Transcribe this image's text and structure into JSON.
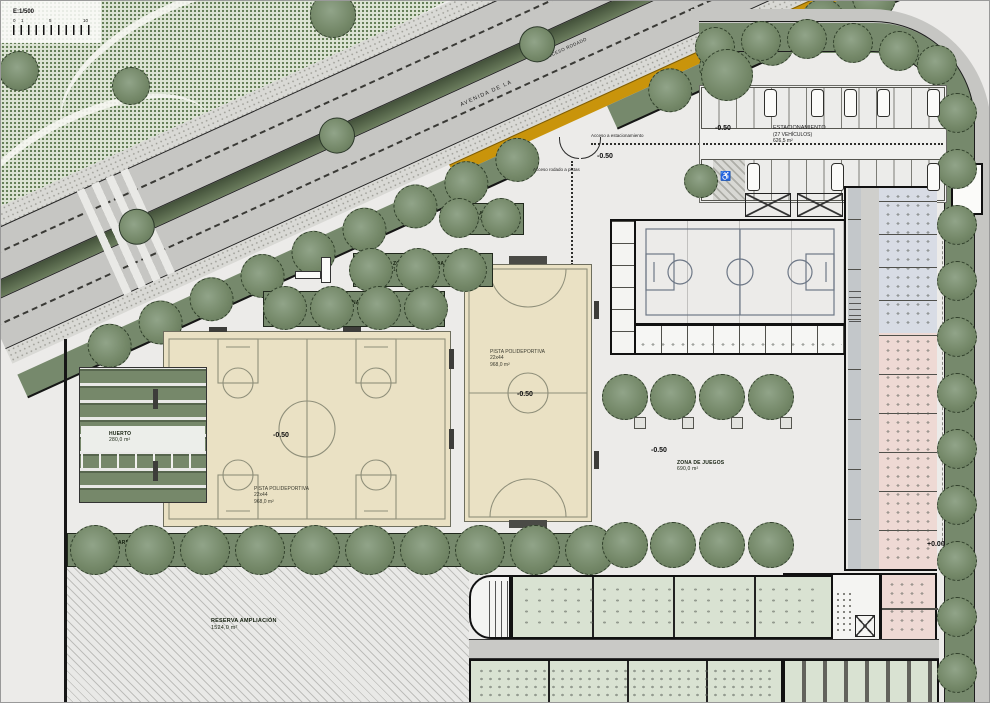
{
  "scale": {
    "label": "E:1/500",
    "tick0": "0",
    "tick1": "1",
    "tick5": "5",
    "tick10": "10"
  },
  "road": {
    "name": "AVENIDA DE LA",
    "access": "ACCESO RODADO"
  },
  "entrances": {
    "parking_path": "Acceso a estacionamiento",
    "courts_path": "Acceso rodado a pistas"
  },
  "parking": {
    "name": "ESTACIONAMIENTO",
    "capacity": "(27 VEHÍCULOS)",
    "area": "626,5 m²",
    "level_west": "-0.50",
    "level_east": "-0.50",
    "accessible_icon": "♿"
  },
  "courts": {
    "multi": {
      "name": "PISTA POLIDEPORTIVA",
      "dims": "22x44",
      "area": "968,0 m²",
      "level": "-0.50"
    },
    "futsal": {
      "name": "PISTA POLIDEPORTIVA",
      "dims": "22x44",
      "area": "968,0 m²",
      "level": "-0.50"
    }
  },
  "zones": {
    "garden1": {
      "name": "ZONA AJARDINADA 1",
      "area": "74,5 m²"
    },
    "garden2": {
      "name": "ZONA AJARDINADA 2",
      "area": "105,5 m²"
    },
    "garden3": {
      "name": "ZONA AJARDINADA 3",
      "area": "129,5 m²"
    },
    "garden4": {
      "name": "ZONA AJARDINADA 4",
      "area": "135,0 m²"
    },
    "orchard": {
      "name": "HUERTO",
      "area": "280,0 m²"
    },
    "playground": {
      "name": "ZONA DE JUEGOS",
      "area": "690,0 m²",
      "level": "-0.50"
    },
    "reserve": {
      "name": "RESERVA AMPLIACIÓN",
      "area": "1524,0 m²"
    }
  },
  "levels": {
    "entrance": "-0.50",
    "site_east": "+0.00"
  },
  "buildings": {
    "transformer": "C.T."
  },
  "colors": {
    "court_surface": "#EAE1C4",
    "garden_green": "#76896C",
    "median_green": "#4F6046",
    "bike_lane": "#C9940B",
    "gym_floor": "#CFD5DB",
    "classroom_green": "#D9E2D2",
    "room_pink": "#EED9D4",
    "room_blue": "#D8DCE5",
    "asphalt": "#C6C6C3"
  }
}
